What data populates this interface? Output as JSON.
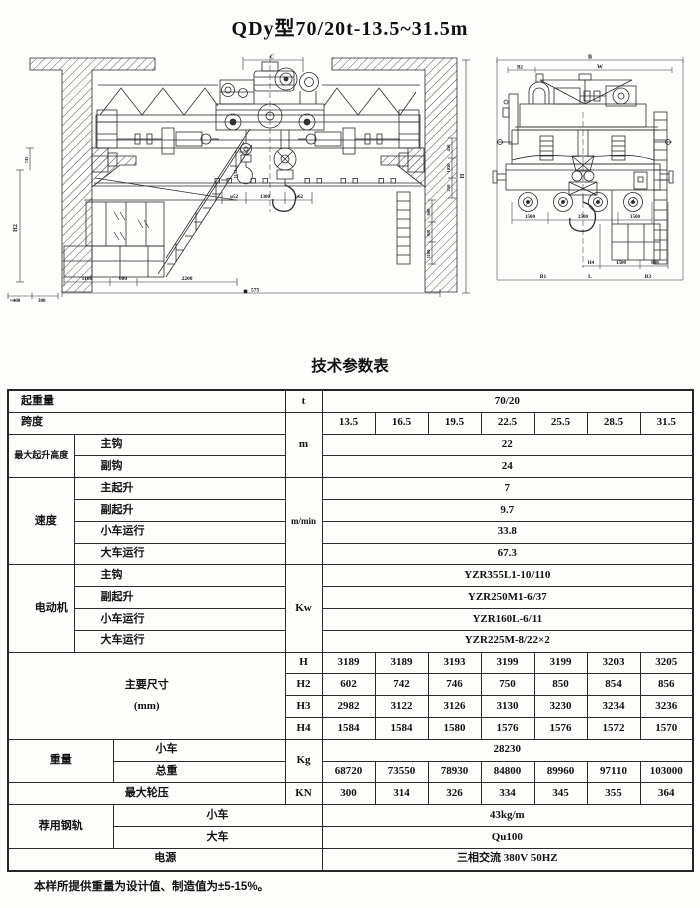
{
  "title": "QDy型70/20t-13.5~31.5m",
  "table_title": "技术参数表",
  "footnote": "本样所提供重量为设计值、制造值为±5-15%。",
  "drawing": {
    "front": {
      "c": "C",
      "aux_dim": "1134",
      "under_rail": [
        "φ52",
        "1300",
        "φ62"
      ],
      "cab_dims": [
        "1100",
        "600",
        "2200"
      ],
      "span": "575",
      "left_small": [
        "≈400",
        "300"
      ],
      "h2": "H2",
      "left_short": "745",
      "right_rot": [
        "600",
        "920",
        "1100"
      ],
      "right_stack": [
        "450",
        "1050",
        "250"
      ],
      "height": "H"
    },
    "side": {
      "b": "B",
      "w": "W",
      "b2": "B2",
      "mid": [
        "1500",
        "2500",
        "1500"
      ],
      "h4": "H4",
      "low": [
        "1500",
        "800"
      ],
      "bottom": [
        "B1",
        "L",
        "B3"
      ]
    }
  },
  "table": {
    "lifting_capacity": {
      "label": "起重量",
      "unit": "t",
      "value": "70/20"
    },
    "span": {
      "label": "跨度",
      "unit": "m",
      "values": [
        "13.5",
        "16.5",
        "19.5",
        "22.5",
        "25.5",
        "28.5",
        "31.5"
      ]
    },
    "lifting_height": {
      "label": "最大起升高度",
      "rows": [
        {
          "label": "主钩",
          "value": "22"
        },
        {
          "label": "副钩",
          "value": "24"
        }
      ]
    },
    "speed": {
      "label": "速度",
      "unit": "m/min",
      "rows": [
        {
          "label": "主起升",
          "value": "7"
        },
        {
          "label": "副起升",
          "value": "9.7"
        },
        {
          "label": "小车运行",
          "value": "33.8"
        },
        {
          "label": "大车运行",
          "value": "67.3"
        }
      ]
    },
    "motor": {
      "label": "电动机",
      "unit": "Kw",
      "rows": [
        {
          "label": "主钩",
          "value": "YZR355L1-10/110"
        },
        {
          "label": "副起升",
          "value": "YZR250M1-6/37"
        },
        {
          "label": "小车运行",
          "value": "YZR160L-6/11"
        },
        {
          "label": "大车运行",
          "value": "YZR225M-8/22×2"
        }
      ]
    },
    "dimensions": {
      "label": "主要尺寸",
      "sublabel": "(mm)",
      "rows": [
        {
          "label": "H",
          "values": [
            "3189",
            "3189",
            "3193",
            "3199",
            "3199",
            "3203",
            "3205"
          ]
        },
        {
          "label": "H2",
          "values": [
            "602",
            "742",
            "746",
            "750",
            "850",
            "854",
            "856"
          ]
        },
        {
          "label": "H3",
          "values": [
            "2982",
            "3122",
            "3126",
            "3130",
            "3230",
            "3234",
            "3236"
          ]
        },
        {
          "label": "H4",
          "values": [
            "1584",
            "1584",
            "1580",
            "1576",
            "1576",
            "1572",
            "1570"
          ]
        }
      ]
    },
    "weight": {
      "label": "重量",
      "unit": "Kg",
      "trolley": {
        "label": "小车",
        "value": "28230"
      },
      "total": {
        "label": "总重",
        "values": [
          "68720",
          "73550",
          "78930",
          "84800",
          "89960",
          "97110",
          "103000"
        ]
      }
    },
    "wheel_load": {
      "label": "最大轮压",
      "unit": "KN",
      "values": [
        "300",
        "314",
        "326",
        "334",
        "345",
        "355",
        "364"
      ]
    },
    "rail": {
      "label": "荐用钢轨",
      "rows": [
        {
          "label": "小车",
          "value": "43kg/m"
        },
        {
          "label": "大车",
          "value": "Qu100"
        }
      ]
    },
    "power": {
      "label": "电源",
      "value": "三相交流  380V  50HZ"
    }
  }
}
